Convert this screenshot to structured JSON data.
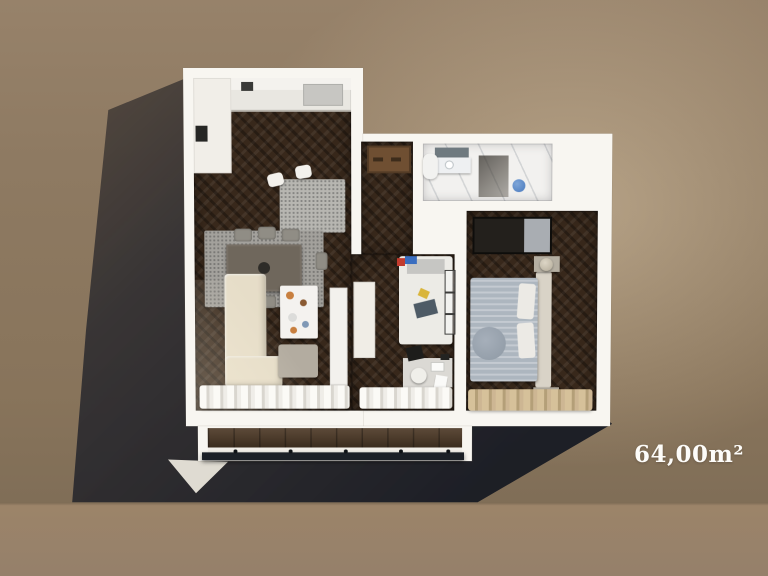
{
  "label": {
    "area": "64,00m²"
  },
  "colors": {
    "wall_white": "#f8f6f1",
    "wood_floor": "#38281b",
    "marble": "#f2f1ef",
    "rug": "#a3a19c",
    "sofa": "#e6ddc8",
    "duvet": "#adb6bf",
    "curtain_beige": "#d6c19a",
    "door_brown": "#6f4f32",
    "toilet_blue": "#4879bd",
    "railing_dark": "#1c2027",
    "backdrop_wall": "#8e7a62",
    "backdrop_floor": "#9a8369",
    "shadow": "#1c1f29"
  },
  "rooms": [
    "kitchen-dining-living",
    "hallway",
    "bathroom",
    "kids-room",
    "master-bedroom",
    "balcony"
  ]
}
